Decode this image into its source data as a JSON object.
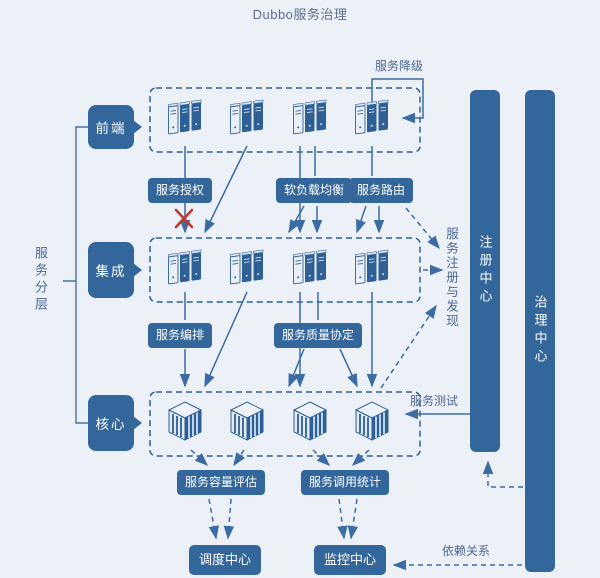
{
  "title": "Dubbo服务治理",
  "colors": {
    "primary": "#33669b",
    "background": "#ecf0f7",
    "line": "#3c6ca3",
    "danger": "#c0392b"
  },
  "left_panel": {
    "group_label": "服务分层",
    "layers": [
      {
        "label": "前端"
      },
      {
        "label": "集成"
      },
      {
        "label": "核心"
      }
    ]
  },
  "labels": {
    "degrade": "服务降级",
    "auth": "服务授权",
    "soft_load_balance": "软负载均衡",
    "route": "服务路由",
    "orchestration": "服务编排",
    "qos_agreement": "服务质量协定",
    "registry_discovery": "服务注册与发现",
    "service_test": "服务测试",
    "capacity_eval": "服务容量评估",
    "invoke_stats": "服务调用统计",
    "dependency": "依赖关系"
  },
  "centers": {
    "dispatch": "调度中心",
    "monitor": "监控中心",
    "registry": "注册中心",
    "governance": "治理中心"
  },
  "icons": {
    "server_cluster": "server-cluster-icon",
    "service_node": "service-cube-icon",
    "blocked": "blocked-x-icon"
  }
}
